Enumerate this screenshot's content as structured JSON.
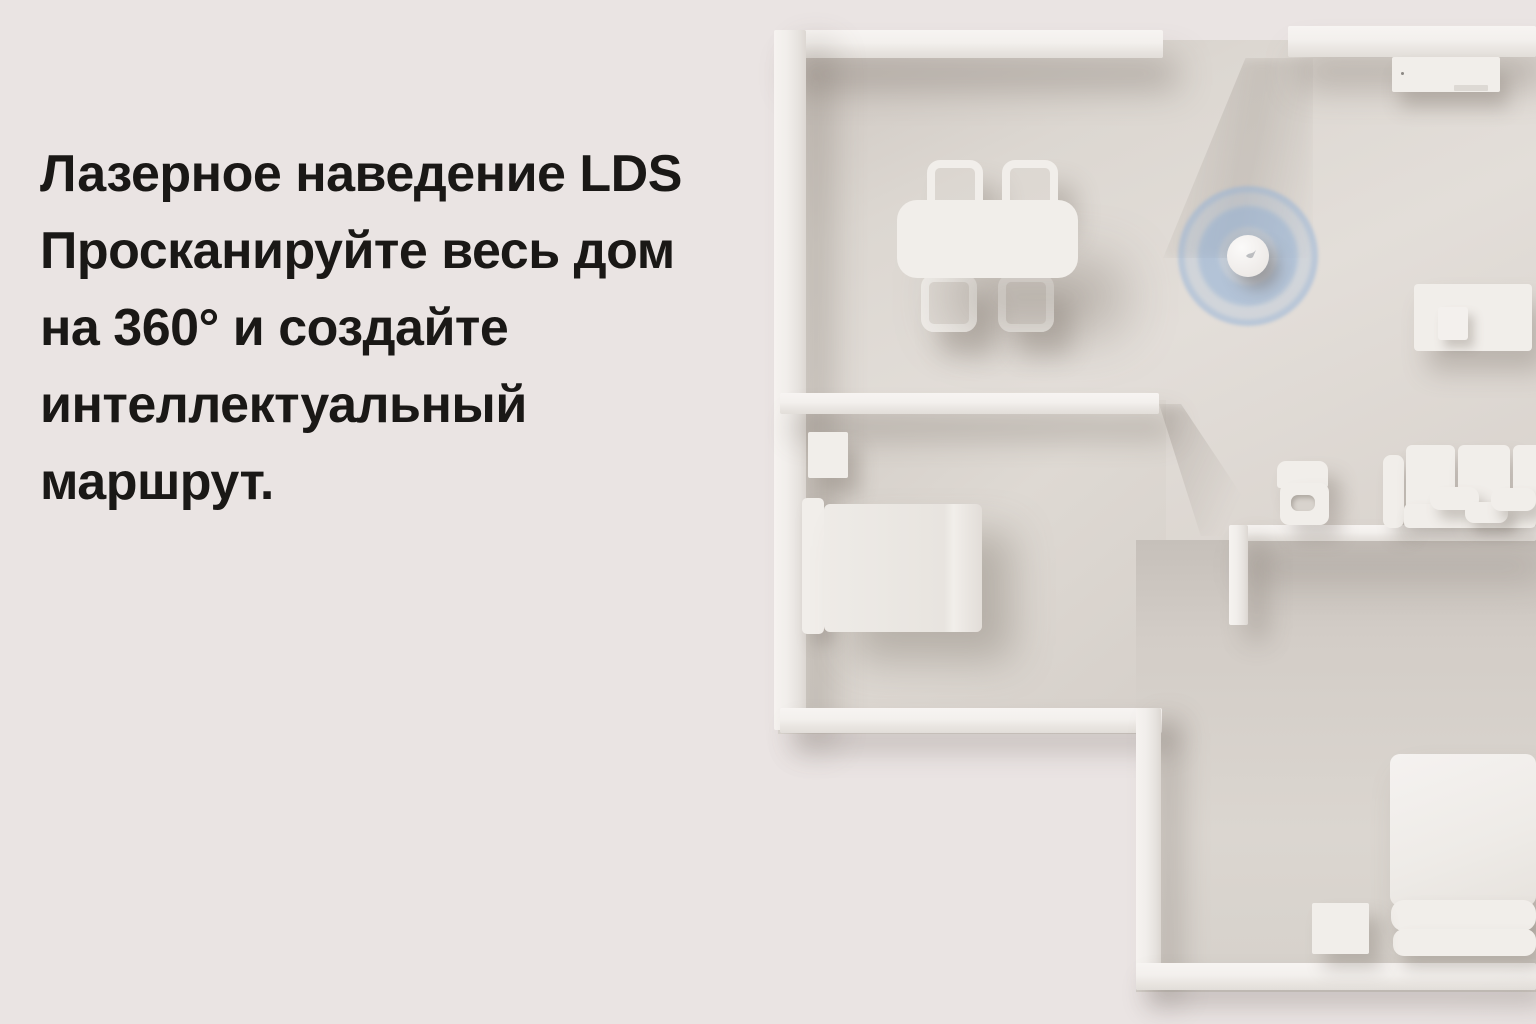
{
  "headline": {
    "lines": [
      "Лазерное наведение LDS",
      "Просканируйте весь дом",
      "на 360° и создайте",
      "интеллектуальный",
      "маршрут."
    ]
  },
  "palette": {
    "background": "#eae4e3",
    "floor": "#dcd7d1",
    "wall_white": "#f2efec",
    "furniture_white": "#f1eeea",
    "text": "#1a1816",
    "scan_ring_blue": "#96b4d8"
  },
  "scene": {
    "type": "top-down 3D render of white apartment floor plan",
    "objects": [
      "robot-vacuum",
      "lds-scan-rings",
      "dining-table",
      "dining-chairs",
      "bed",
      "nightstand",
      "tv-panel",
      "desk",
      "high-chair",
      "sofa",
      "futon",
      "storage-cube",
      "walls"
    ]
  }
}
